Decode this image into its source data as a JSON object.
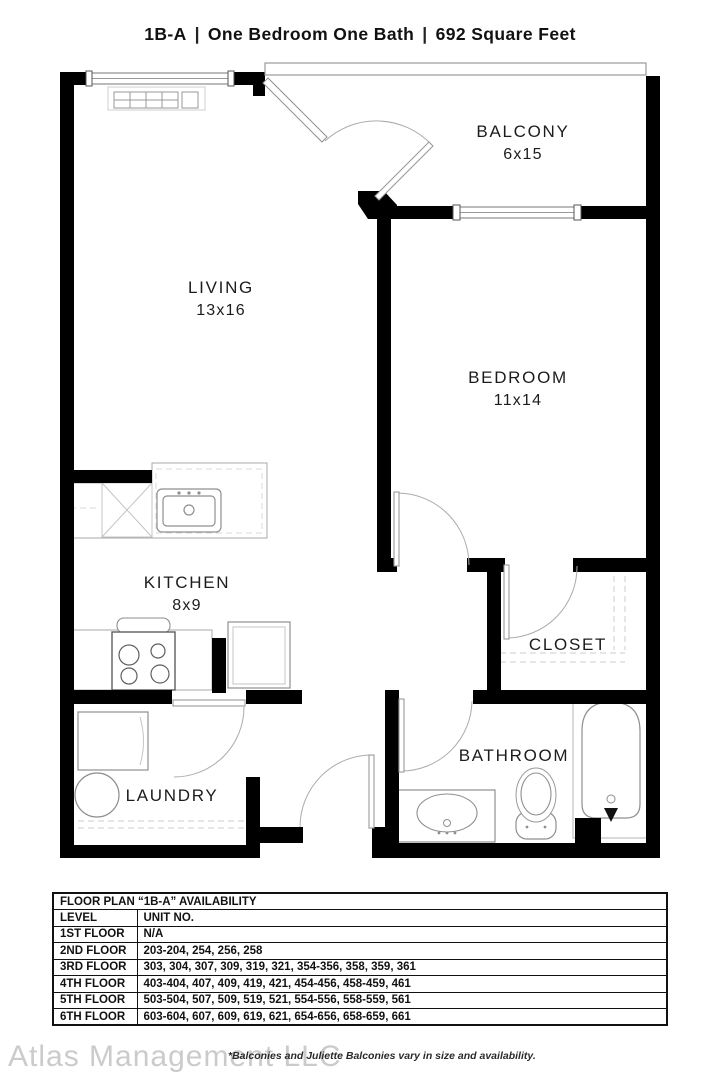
{
  "header": {
    "unit_code": "1B-A",
    "divider": "|",
    "unit_type": "One Bedroom One Bath",
    "unit_size": "692 Square Feet"
  },
  "rooms": {
    "balcony": {
      "name": "BALCONY",
      "dims": "6x15"
    },
    "living": {
      "name": "LIVING",
      "dims": "13x16"
    },
    "bedroom": {
      "name": "BEDROOM",
      "dims": "11x14"
    },
    "kitchen": {
      "name": "KITCHEN",
      "dims": "8x9"
    },
    "closet": {
      "name": "CLOSET"
    },
    "laundry": {
      "name": "LAUNDRY"
    },
    "bathroom": {
      "name": "BATHROOM"
    }
  },
  "availability": {
    "title": "FLOOR PLAN “1B-A” AVAILABILITY",
    "headers": {
      "level": "LEVEL",
      "unit": "UNIT NO."
    },
    "rows": [
      {
        "level": "1ST FLOOR",
        "units": "N/A"
      },
      {
        "level": "2ND FLOOR",
        "units": "203-204, 254, 256, 258"
      },
      {
        "level": "3RD FLOOR",
        "units": "303, 304, 307, 309, 319, 321, 354-356, 358, 359, 361"
      },
      {
        "level": "4TH FLOOR",
        "units": "403-404, 407, 409, 419, 421, 454-456, 458-459, 461"
      },
      {
        "level": "5TH FLOOR",
        "units": "503-504, 507, 509, 519, 521, 554-556, 558-559, 561"
      },
      {
        "level": "6TH FLOOR",
        "units": "603-604, 607, 609, 619, 621, 654-656, 658-659, 661"
      }
    ]
  },
  "footer": {
    "watermark": "Atlas Management LLC",
    "note": "*Balconies and Juliette Balconies vary in size and availability."
  },
  "colors": {
    "wall": "#000000",
    "fixture_line": "#8f8f8f",
    "text": "#1b1b1b",
    "watermark": "#cbcbcb"
  }
}
